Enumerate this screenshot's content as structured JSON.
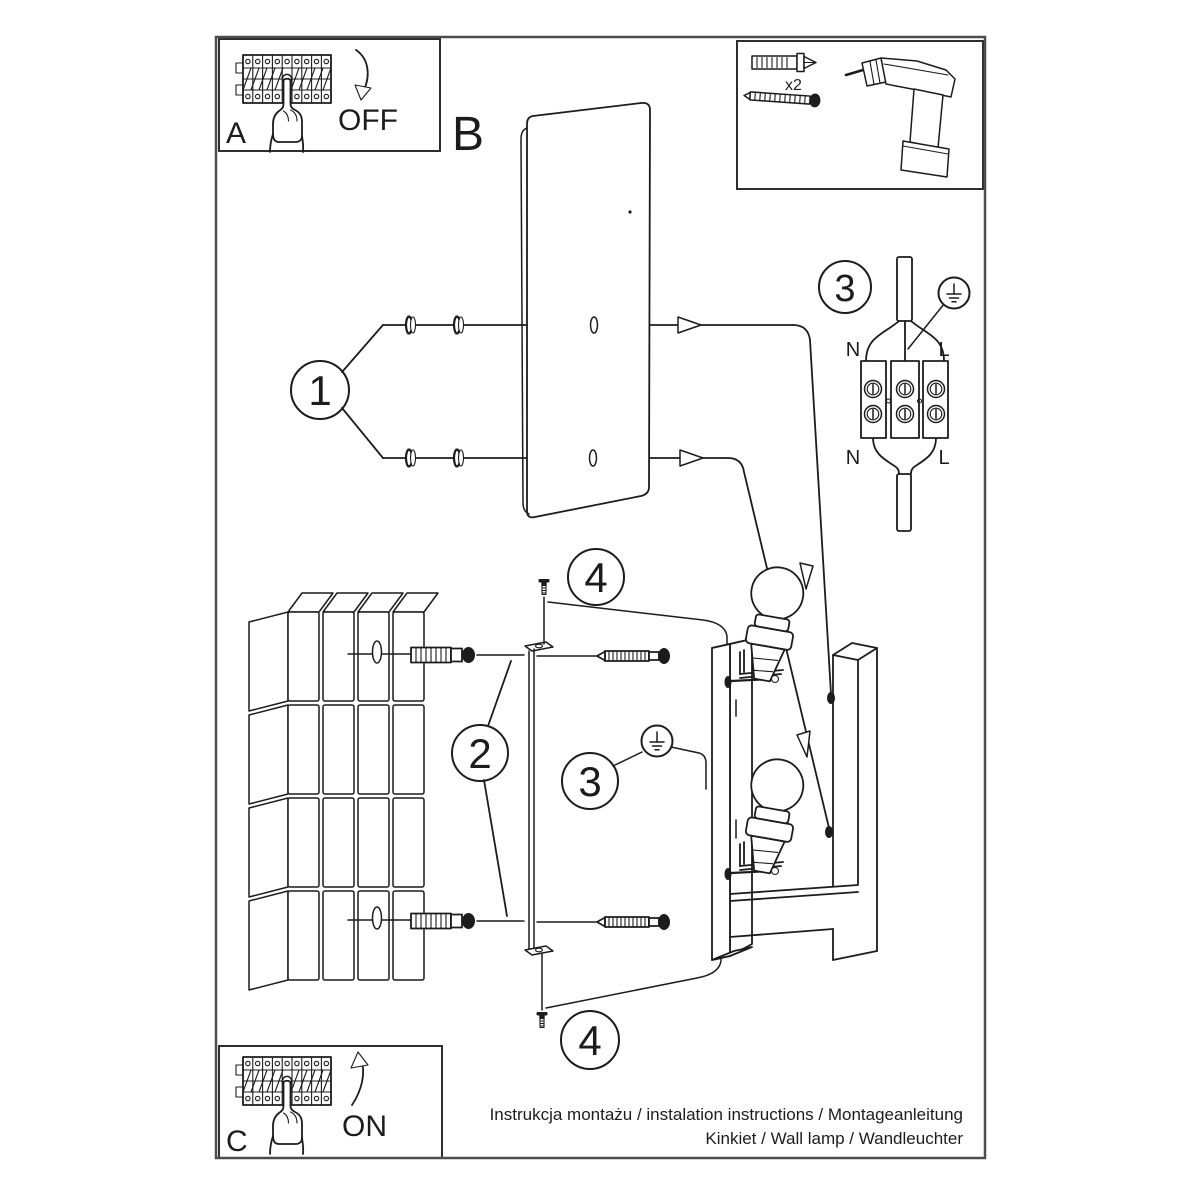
{
  "sheet": {
    "background": "#ffffff",
    "ink_color": "#1c1c1c",
    "frame_color": "#4d4d4d"
  },
  "panel_a": {
    "label": "A",
    "state": "OFF"
  },
  "panel_b": {
    "label": "B"
  },
  "panel_c": {
    "label": "C",
    "state": "ON"
  },
  "tools": {
    "dowel_count": "x2"
  },
  "steps": {
    "washers": "1",
    "bracket": "2",
    "wiring": "3",
    "ground": "3",
    "screw_top": "4",
    "screw_bottom": "4"
  },
  "wiring_labels": {
    "top_left": "N",
    "top_right": "L",
    "bottom_left": "N",
    "bottom_right": "L"
  },
  "footer": {
    "line1": "Instrukcja montażu / instalation instructions / Montageanleitung",
    "line2": "Kinkiet / Wall lamp / Wandleuchter"
  }
}
